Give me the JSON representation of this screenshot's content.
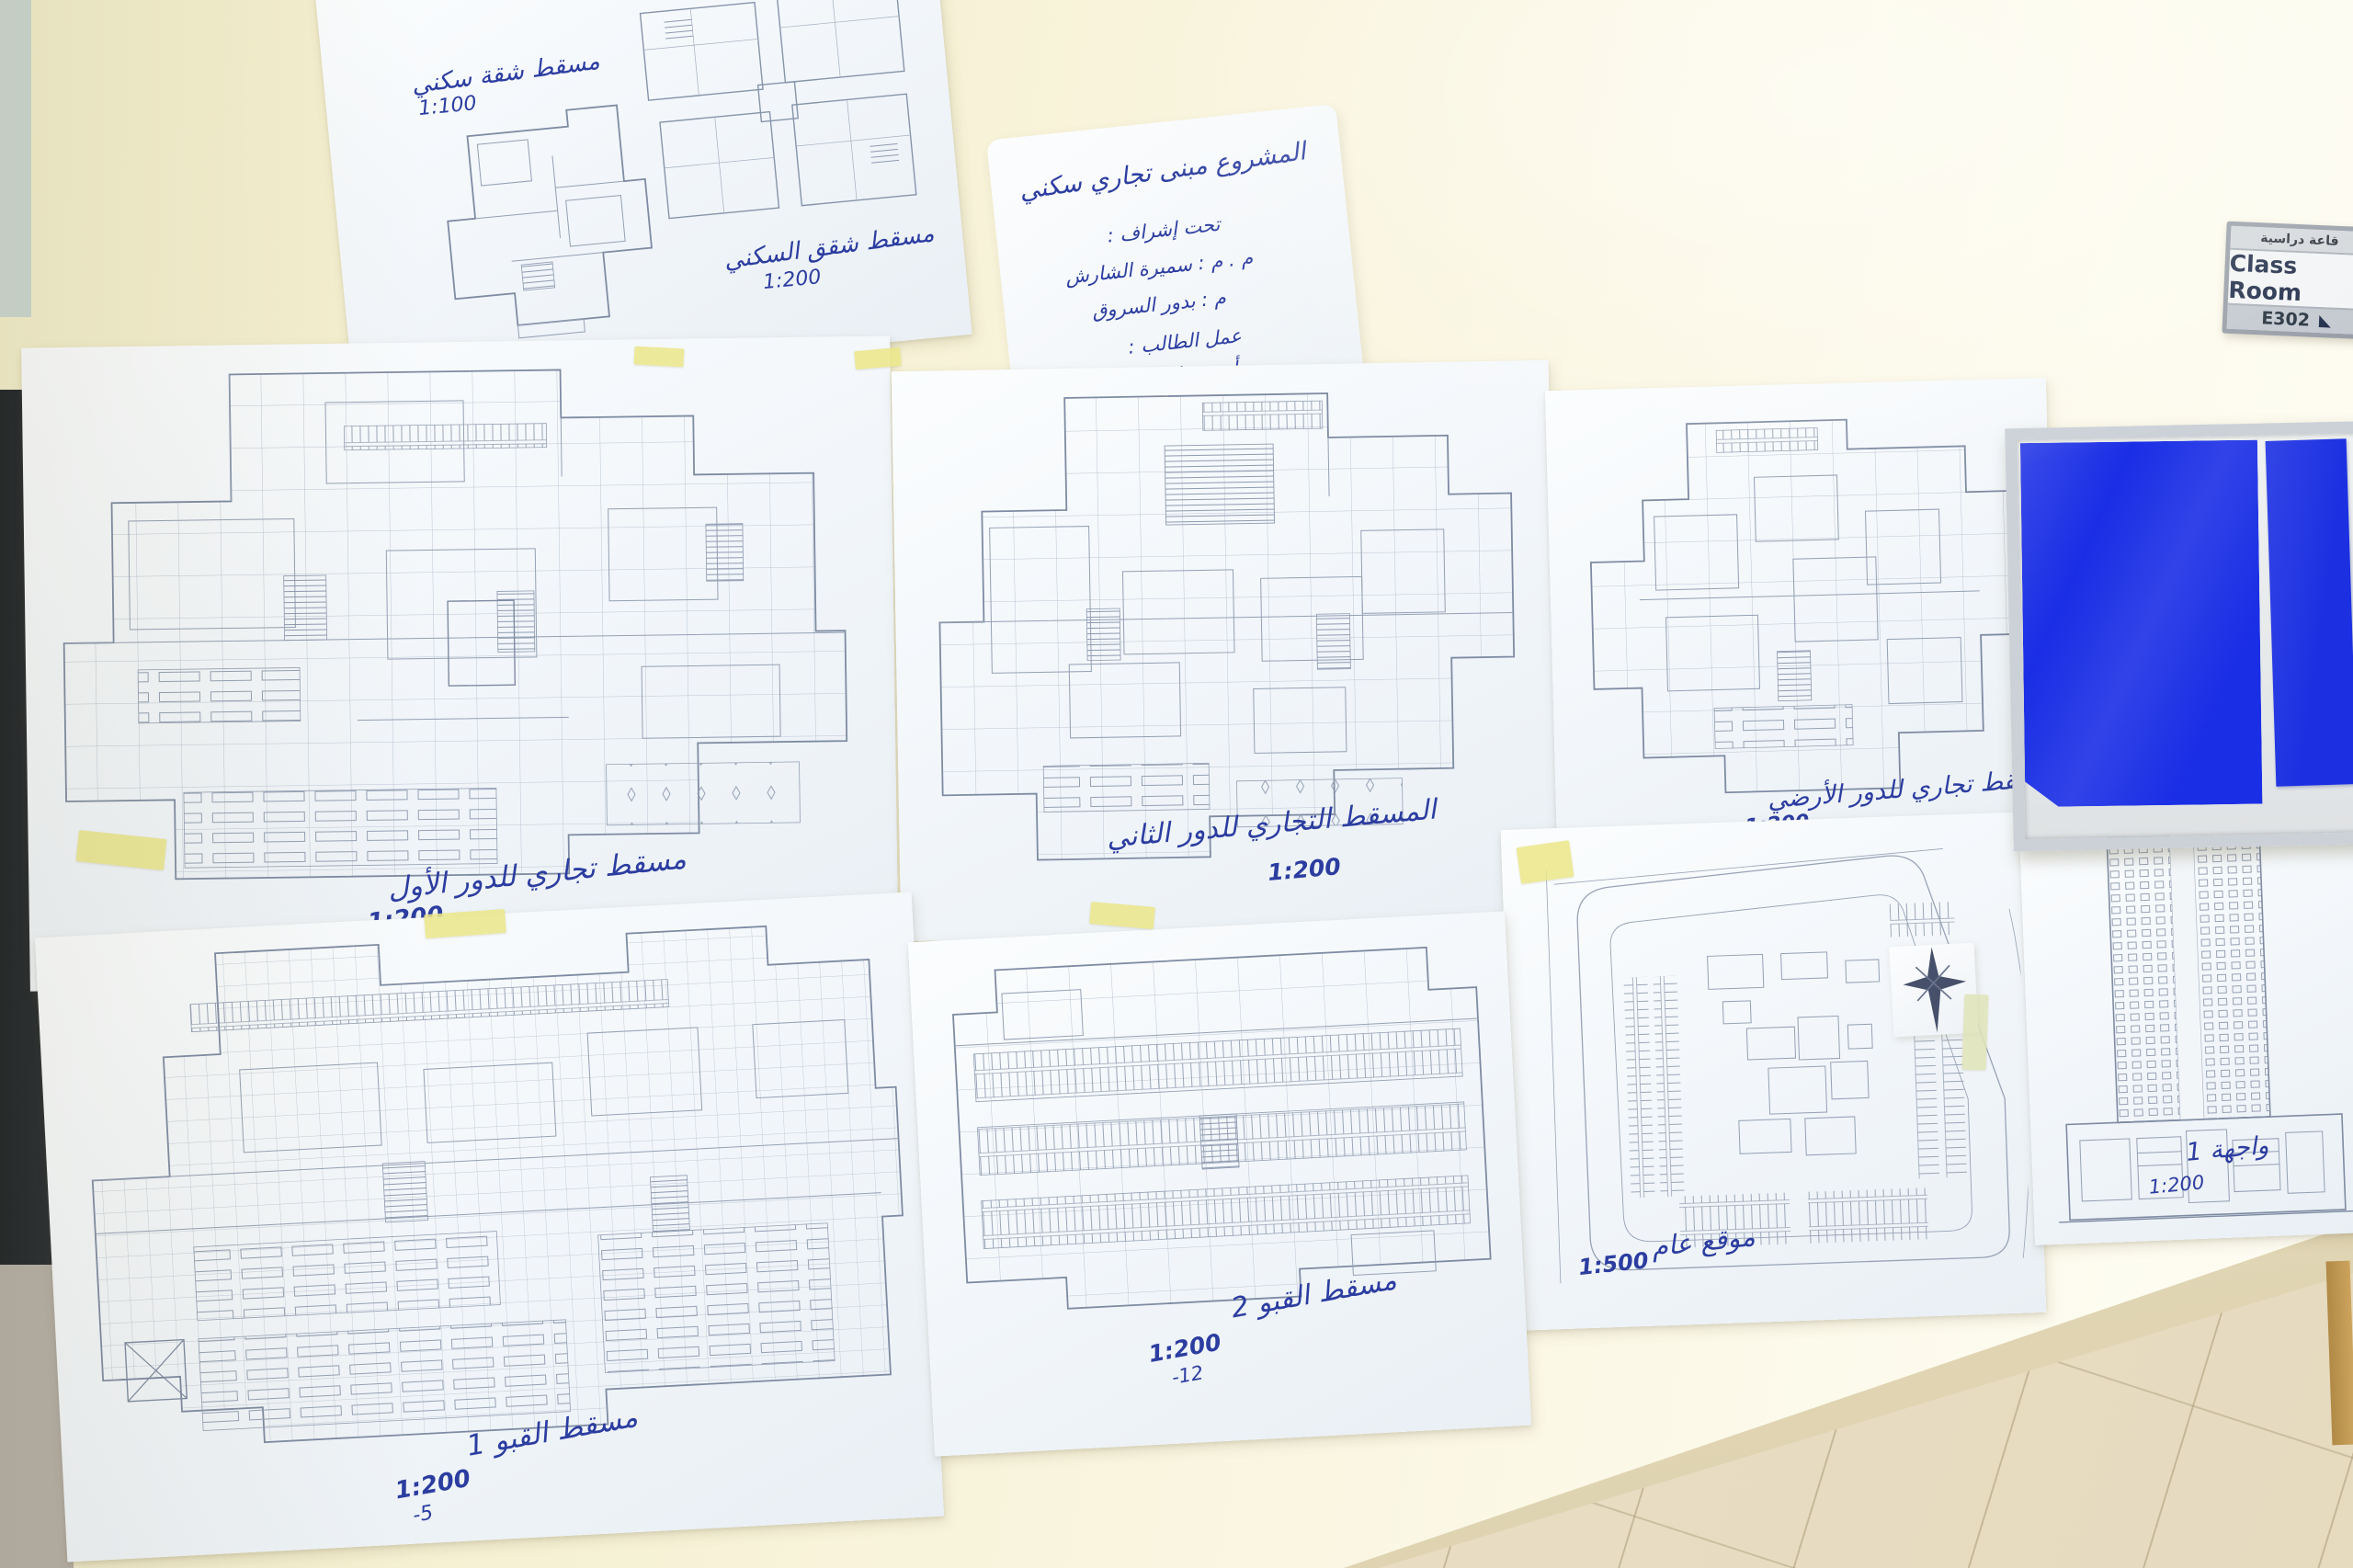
{
  "room_sign": {
    "arabic_label": "قاعة دراسية",
    "english_label": "Class Room",
    "room_number": "E302"
  },
  "title_card": {
    "line1": "المشروع مبنى تجاري سكني",
    "line2": "تحت إشراف :",
    "line3": "م . م : سميرة الشارش",
    "line4": "م : بدور السروق",
    "line5": "عمل الطالب :",
    "line6": "أمجد عادل العبيدي"
  },
  "sheets": {
    "apartment": {
      "caption": "مسقط شقة سكني",
      "scale": "1:100"
    },
    "apartment_cluster": {
      "caption": "مسقط شقق السكني",
      "scale": "1:200"
    },
    "commercial_first": {
      "caption": "مسقط تجاري للدور الأول",
      "scale": "1:200"
    },
    "commercial_second": {
      "caption": "المسقط التجاري للدور الثاني",
      "scale": "1:200"
    },
    "commercial_ground": {
      "caption": "مسقط تجاري للدور الأرضي",
      "scale": "1:200"
    },
    "basement1": {
      "caption": "مسقط القبو 1",
      "scale": "1:200",
      "level": "-5"
    },
    "basement2": {
      "caption": "مسقط القبو 2",
      "scale": "1:200",
      "level": "-12"
    },
    "site": {
      "caption": "موقع عام",
      "scale": "1:500"
    },
    "elevation": {
      "caption": "واجهة 1",
      "scale": "1:200"
    }
  }
}
